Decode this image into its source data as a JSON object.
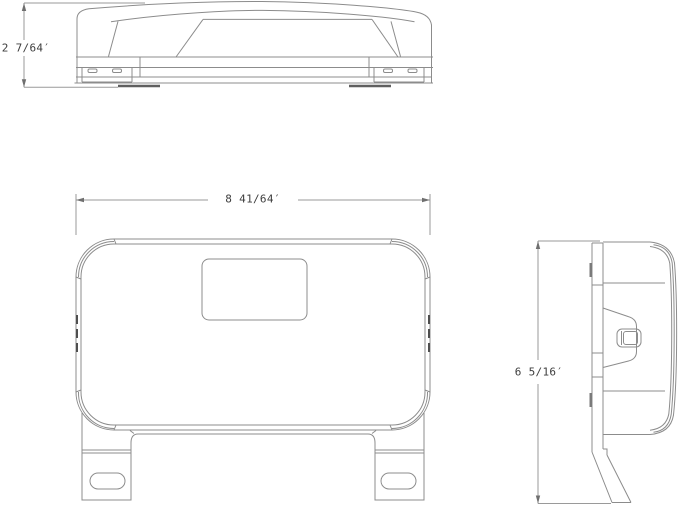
{
  "drawing_type": "orthographic technical drawing, three views of a wall-mounted emergency light fixture",
  "colors": {
    "background": "#ffffff",
    "line": "#8c8c8c",
    "dimension_line": "#9a9a9a",
    "text": "#3d3d3d"
  },
  "views": {
    "top": {
      "height_label": "2 7/64′"
    },
    "front": {
      "width_label": "8 41/64′"
    },
    "side": {
      "height_label": "6 5/16′"
    }
  }
}
